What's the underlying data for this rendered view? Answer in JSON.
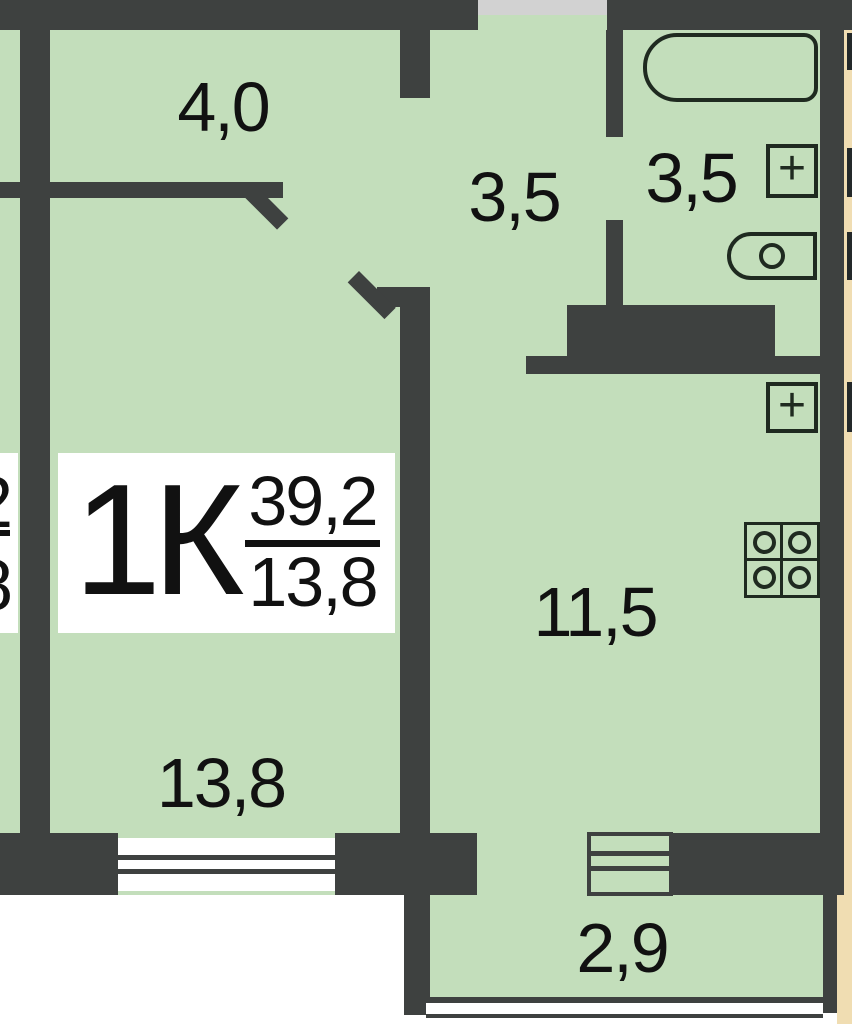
{
  "floorplan": {
    "apartment_label": {
      "unit_type": "1К",
      "total_area": "39,2",
      "living_area": "13,8"
    },
    "neighbor_label": {
      "top_partial": "2",
      "bottom_partial": "8"
    },
    "areas": {
      "hallway": "4,0",
      "corridor": "3,5",
      "bathroom": "3,5",
      "kitchen": "11,5",
      "living_room": "13,8",
      "balcony": "2,9"
    },
    "fixture_marks": {
      "bathroom_panel": "+",
      "kitchen_panel": "+"
    },
    "colors": {
      "green": "#c3debb",
      "wall": "#3e4140",
      "tan": "#f0ddb2",
      "gray": "#d2d2d2",
      "white": "#ffffff",
      "outline": "#1f2a20",
      "ink": "#111111"
    }
  }
}
